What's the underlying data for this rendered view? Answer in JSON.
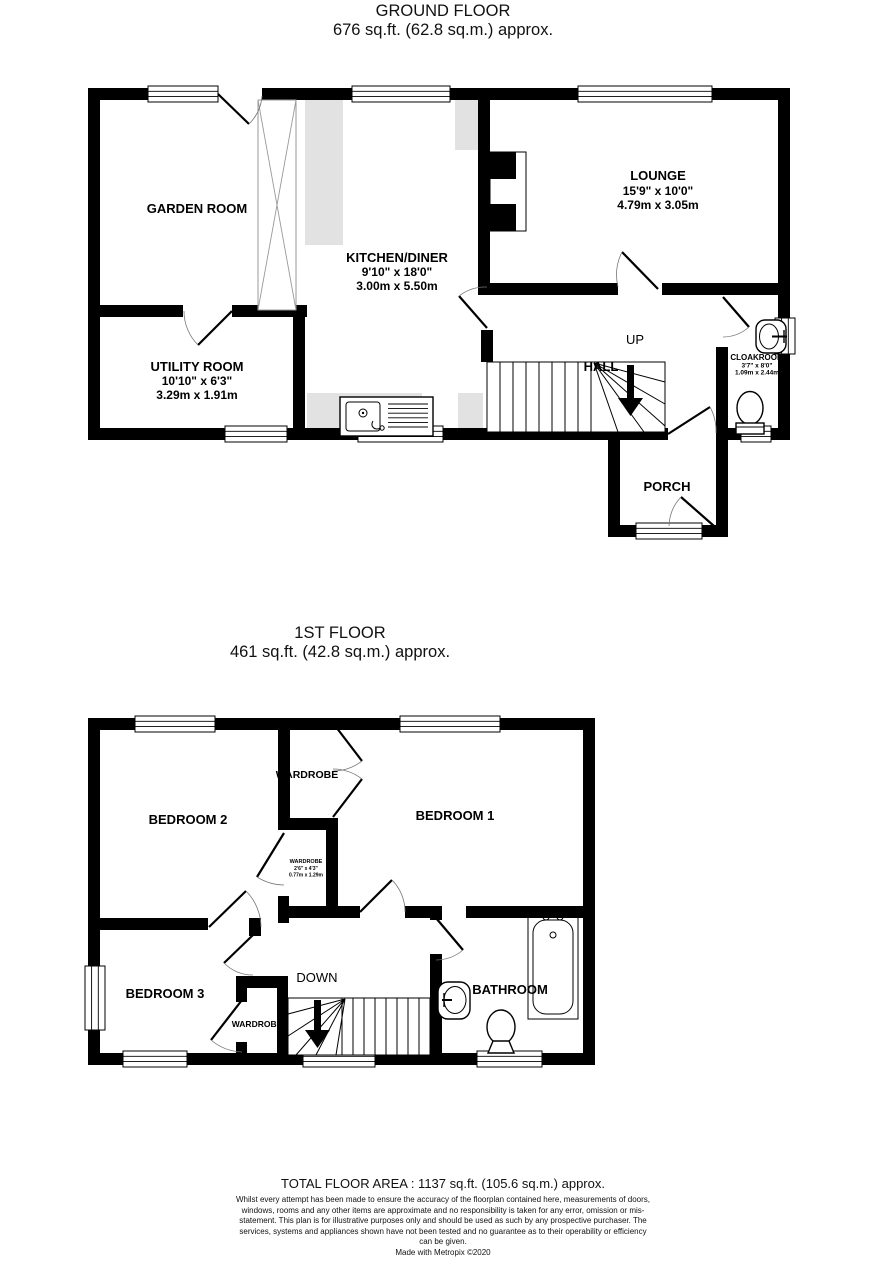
{
  "ground_floor": {
    "title": "GROUND FLOOR",
    "subtitle": "676 sq.ft. (62.8 sq.m.) approx.",
    "rooms": {
      "garden_room": {
        "name": "GARDEN ROOM"
      },
      "kitchen": {
        "name": "KITCHEN/DINER",
        "imperial": "9'10\" x 18'0\"",
        "metric": "3.00m x 5.50m"
      },
      "utility": {
        "name": "UTILITY ROOM",
        "imperial": "10'10\" x 6'3\"",
        "metric": "3.29m x 1.91m"
      },
      "lounge": {
        "name": "LOUNGE",
        "imperial": "15'9\" x 10'0\"",
        "metric": "4.79m x 3.05m"
      },
      "hall": {
        "name": "HALL"
      },
      "cloakroom": {
        "name": "CLOAKROOM",
        "imperial": "3'7\" x 8'0\"",
        "metric": "1.09m x 2.44m"
      },
      "porch": {
        "name": "PORCH"
      },
      "stairs_direction": "UP"
    }
  },
  "first_floor": {
    "title": "1ST FLOOR",
    "subtitle": "461 sq.ft. (42.8 sq.m.) approx.",
    "rooms": {
      "bedroom1": {
        "name": "BEDROOM 1"
      },
      "bedroom2": {
        "name": "BEDROOM 2"
      },
      "bedroom3": {
        "name": "BEDROOM 3"
      },
      "bathroom": {
        "name": "BATHROOM"
      },
      "wardrobe_bedroom1": {
        "name": "WARDROBE"
      },
      "wardrobe_small": {
        "name": "WARDROBE",
        "imperial": "2'6\" x 4'3\"",
        "metric": "0.77m x 1.29m"
      },
      "wardrobe_bedroom3": {
        "name": "WARDROBE"
      },
      "stairs_direction": "DOWN"
    }
  },
  "footer": {
    "total_area": "TOTAL FLOOR AREA : 1137 sq.ft. (105.6 sq.m.) approx.",
    "disclaimer": "Whilst every attempt has been made to ensure the accuracy of the floorplan contained here, measurements of doors, windows, rooms and any other items are approximate and no responsibility is taken for any error, omission or mis-statement. This plan is for illustrative purposes only and should be used as such by any prospective purchaser. The services, systems and appliances shown have not been tested and no guarantee as to their operability or efficiency can be given.",
    "credit": "Made with Metropix ©2020"
  },
  "colors": {
    "wall": "#000000",
    "counter": "#e2e2e2",
    "background": "#ffffff"
  }
}
